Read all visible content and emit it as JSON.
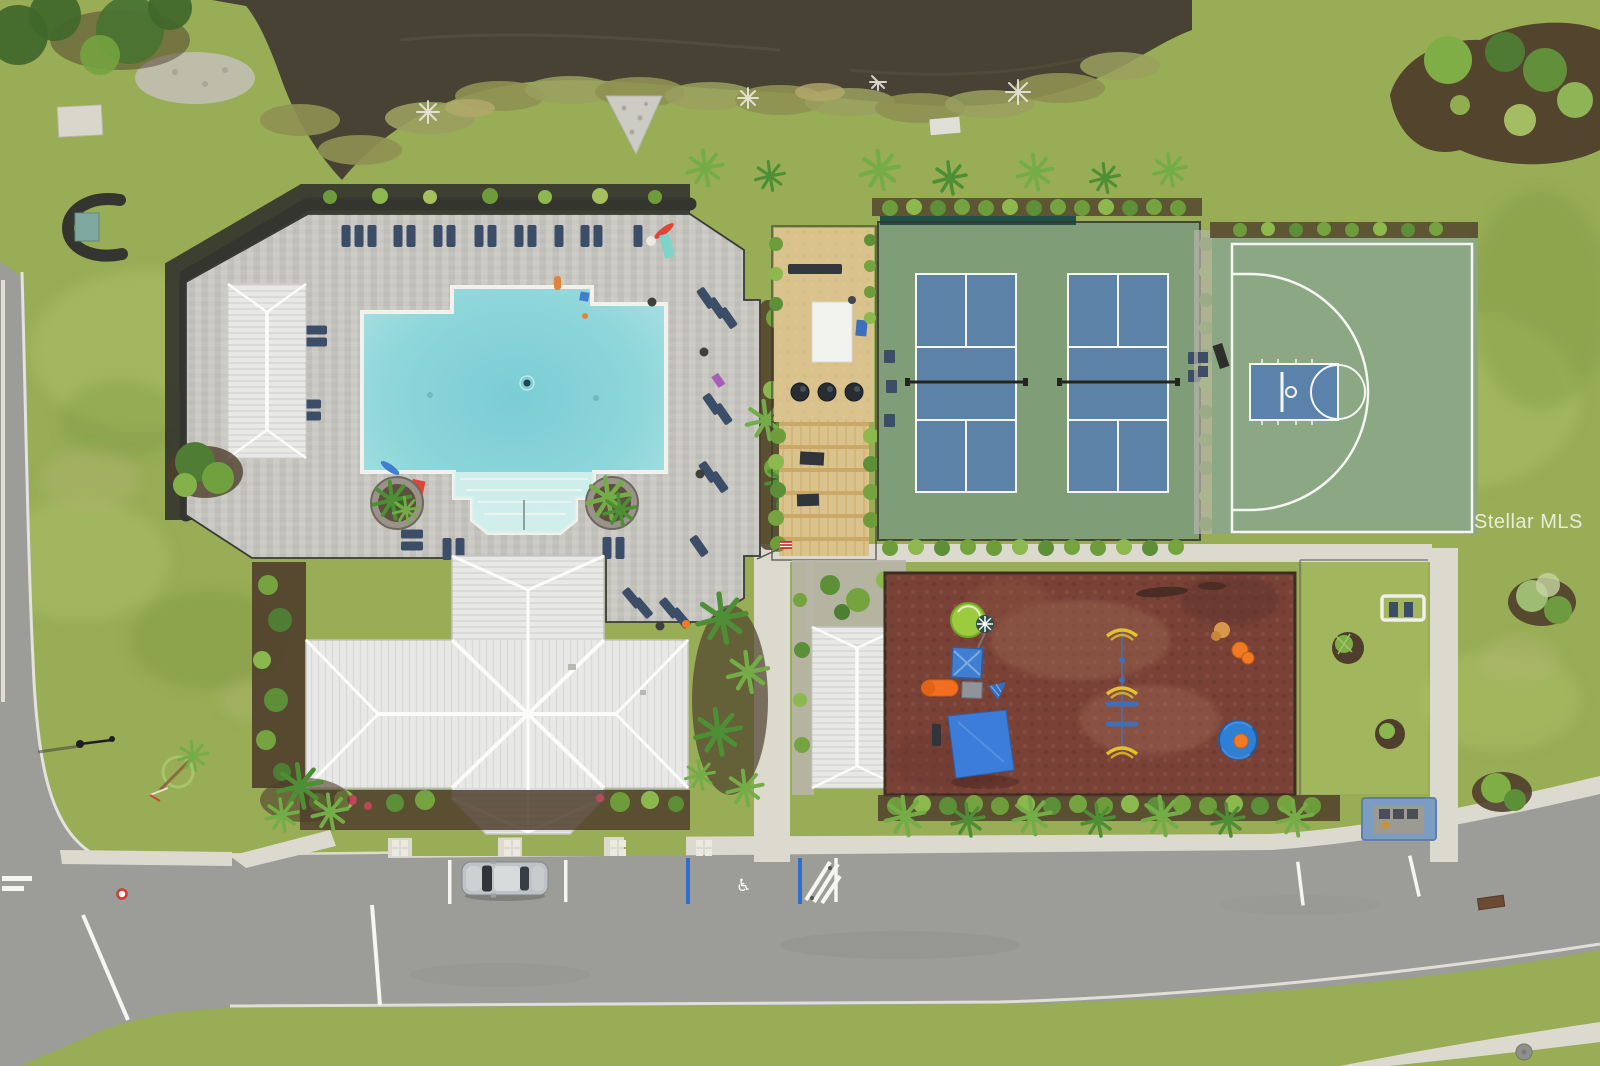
{
  "watermark": {
    "text": "Stellar MLS"
  },
  "parking": {
    "handicap_symbol": "♿"
  },
  "scene": {
    "type": "aerial-drone-photo",
    "landmarks": [
      "pond",
      "community-pool",
      "pool-deck",
      "clubhouse",
      "pool-cabana-building",
      "picnic-grill-area",
      "pergola",
      "pickleball-courts",
      "basketball-half-court",
      "playground",
      "playground-building",
      "shade-sail",
      "fitness-stations",
      "east-lawn",
      "bench-swing",
      "mail-kiosk",
      "street",
      "parallel-parking",
      "handicap-parking",
      "parked-car",
      "street-lamp"
    ]
  },
  "colors": {
    "grass": "#98ad55",
    "grass_light": "#acc068",
    "grass_dark": "#7c9742",
    "pond": "#474234",
    "road": "#9c9c99",
    "sidewalk": "#dcd9cf",
    "curb": "#eceae2",
    "deck": "#c7c6c1",
    "pool": "#84d0d6",
    "pool_light": "#b2e4e4",
    "pool_beach": "#d6efec",
    "roof": "#e8e8e6",
    "hedge": "#7cb23f",
    "hedge_dark": "#5f9431",
    "mulch": "#4f3e2c",
    "sand": "#d9c28c",
    "pergola": "#c9a868",
    "gravel": "#b7b5aa",
    "court_green": "#7f9e78",
    "court_blue": "#5d82a8",
    "line": "#f5f5f2",
    "bball_green": "#8ba784",
    "bball_blue": "#5b82ab",
    "play_red": "#7a4237",
    "navy": "#3c4d68",
    "accent_red": "#e04538",
    "orange": "#f07b24",
    "accent_blue": "#3f7fd1",
    "sail": "#3b7dd8",
    "screen_teal": "#1f4f49",
    "kiosk": "#7d9cc2",
    "float_teal": "#7ed4c9",
    "palm": "#4e8f35",
    "palm_light": "#74ad47"
  }
}
